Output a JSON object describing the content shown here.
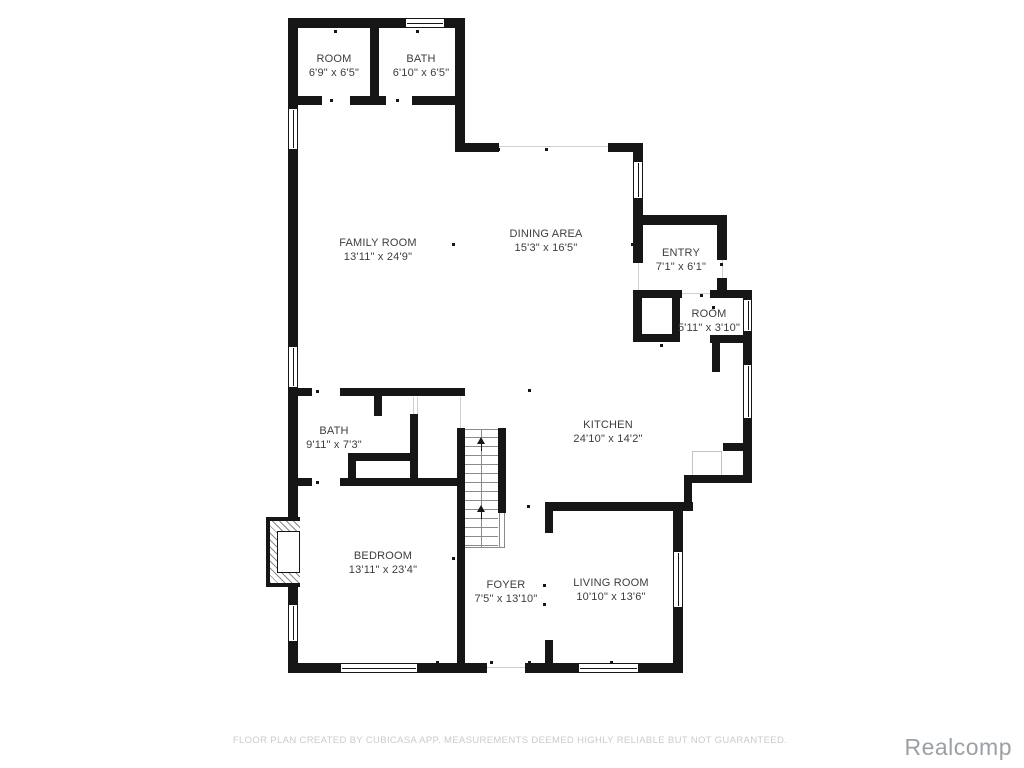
{
  "footer": {
    "disclaimer": "FLOOR PLAN CREATED BY CUBICASA APP. MEASUREMENTS DEEMED HIGHLY RELIABLE BUT NOT GUARANTEED.",
    "watermark": "Realcomp"
  },
  "colors": {
    "wall": "#161616",
    "label": "#3d3d3d",
    "opening_line": "#cfcfcf",
    "stair_line": "#8a8a8a",
    "disclaimer": "#cbcbcb",
    "watermark": "#9aa0a5"
  },
  "rooms": [
    {
      "id": "room-top",
      "name": "ROOM",
      "dims": "6'9\" x 6'5\"",
      "cx": 334,
      "cy": 66
    },
    {
      "id": "bath-top",
      "name": "BATH",
      "dims": "6'10\" x 6'5\"",
      "cx": 421,
      "cy": 66
    },
    {
      "id": "family-room",
      "name": "FAMILY ROOM",
      "dims": "13'11\" x 24'9\"",
      "cx": 378,
      "cy": 250
    },
    {
      "id": "dining-area",
      "name": "DINING AREA",
      "dims": "15'3\" x 16'5\"",
      "cx": 546,
      "cy": 241
    },
    {
      "id": "entry",
      "name": "ENTRY",
      "dims": "7'1\" x 6'1\"",
      "cx": 681,
      "cy": 260
    },
    {
      "id": "room-side",
      "name": "ROOM",
      "dims": "5'11\" x 3'10\"",
      "cx": 709,
      "cy": 321
    },
    {
      "id": "bath-main",
      "name": "BATH",
      "dims": "9'11\" x 7'3\"",
      "cx": 334,
      "cy": 438
    },
    {
      "id": "kitchen",
      "name": "KITCHEN",
      "dims": "24'10\" x 14'2\"",
      "cx": 608,
      "cy": 432
    },
    {
      "id": "bedroom",
      "name": "BEDROOM",
      "dims": "13'11\" x 23'4\"",
      "cx": 383,
      "cy": 563
    },
    {
      "id": "foyer",
      "name": "FOYER",
      "dims": "7'5\" x 13'10\"",
      "cx": 506,
      "cy": 592
    },
    {
      "id": "living-room",
      "name": "LIVING ROOM",
      "dims": "10'10\" x 13'6\"",
      "cx": 611,
      "cy": 590
    }
  ],
  "plan": {
    "walls": [
      [
        288,
        18,
        177,
        10
      ],
      [
        288,
        18,
        10,
        378
      ],
      [
        288,
        396,
        10,
        126
      ],
      [
        288,
        582,
        10,
        90
      ],
      [
        370,
        24,
        9,
        76
      ],
      [
        288,
        96,
        34,
        9
      ],
      [
        350,
        96,
        36,
        9
      ],
      [
        412,
        96,
        53,
        9
      ],
      [
        455,
        18,
        10,
        134
      ],
      [
        455,
        143,
        44,
        9
      ],
      [
        608,
        143,
        35,
        9
      ],
      [
        633,
        143,
        10,
        82
      ],
      [
        633,
        225,
        10,
        38
      ],
      [
        633,
        215,
        94,
        10
      ],
      [
        717,
        215,
        10,
        45
      ],
      [
        717,
        278,
        10,
        20
      ],
      [
        633,
        290,
        49,
        8
      ],
      [
        710,
        290,
        42,
        8
      ],
      [
        633,
        290,
        9,
        52
      ],
      [
        672,
        290,
        8,
        52
      ],
      [
        633,
        334,
        47,
        8
      ],
      [
        743,
        290,
        9,
        53
      ],
      [
        710,
        335,
        42,
        8
      ],
      [
        712,
        343,
        8,
        29
      ],
      [
        743,
        335,
        9,
        148
      ],
      [
        723,
        443,
        20,
        8
      ],
      [
        684,
        475,
        68,
        8
      ],
      [
        684,
        475,
        8,
        35
      ],
      [
        545,
        502,
        148,
        9
      ],
      [
        545,
        502,
        8,
        31
      ],
      [
        673,
        502,
        10,
        170
      ],
      [
        545,
        640,
        8,
        27
      ],
      [
        288,
        663,
        199,
        10
      ],
      [
        525,
        663,
        158,
        10
      ],
      [
        288,
        388,
        24,
        8
      ],
      [
        340,
        388,
        125,
        8
      ],
      [
        374,
        396,
        8,
        20
      ],
      [
        410,
        414,
        8,
        70
      ],
      [
        348,
        453,
        69,
        8
      ],
      [
        348,
        461,
        8,
        25
      ],
      [
        288,
        478,
        24,
        8
      ],
      [
        340,
        478,
        117,
        8
      ],
      [
        457,
        428,
        8,
        244
      ],
      [
        498,
        428,
        8,
        85
      ]
    ],
    "windows": [
      [
        405,
        18,
        40,
        10
      ],
      [
        288,
        108,
        10,
        42
      ],
      [
        288,
        346,
        10,
        42
      ],
      [
        288,
        604,
        10,
        38
      ],
      [
        633,
        161,
        10,
        38
      ],
      [
        743,
        299,
        9,
        33
      ],
      [
        743,
        364,
        9,
        55
      ],
      [
        673,
        551,
        10,
        57
      ],
      [
        340,
        663,
        78,
        10
      ],
      [
        578,
        663,
        61,
        10
      ]
    ],
    "openings": [
      [
        499,
        146,
        109,
        1
      ],
      [
        682,
        293,
        28,
        1
      ],
      [
        487,
        667,
        38,
        1
      ],
      [
        722,
        260,
        1,
        18
      ],
      [
        638,
        263,
        1,
        27
      ],
      [
        413,
        397,
        1,
        17
      ],
      [
        417,
        397,
        1,
        17
      ],
      [
        460,
        397,
        1,
        31
      ]
    ],
    "stair_lines": [
      [
        465,
        429,
        33,
        1
      ],
      [
        481,
        430,
        1,
        117
      ],
      [
        465,
        437,
        33,
        1
      ],
      [
        465,
        446,
        33,
        1
      ],
      [
        465,
        455,
        33,
        1
      ],
      [
        465,
        464,
        33,
        1
      ],
      [
        465,
        473,
        33,
        1
      ],
      [
        465,
        482,
        33,
        1
      ],
      [
        465,
        491,
        33,
        1
      ],
      [
        465,
        500,
        33,
        1
      ],
      [
        465,
        509,
        33,
        1
      ],
      [
        465,
        518,
        33,
        1
      ],
      [
        465,
        527,
        33,
        1
      ],
      [
        465,
        536,
        33,
        1
      ],
      [
        465,
        545,
        33,
        1
      ],
      [
        499,
        513,
        1,
        35
      ],
      [
        504,
        513,
        1,
        35
      ],
      [
        465,
        547,
        40,
        1
      ]
    ],
    "ticks": [
      [
        334,
        30
      ],
      [
        416,
        30
      ],
      [
        330,
        99
      ],
      [
        396,
        99
      ],
      [
        294,
        243
      ],
      [
        452,
        243
      ],
      [
        497,
        148
      ],
      [
        545,
        148
      ],
      [
        631,
        243
      ],
      [
        678,
        217
      ],
      [
        720,
        263
      ],
      [
        712,
        306
      ],
      [
        700,
        294
      ],
      [
        660,
        344
      ],
      [
        528,
        389
      ],
      [
        316,
        390
      ],
      [
        316,
        481
      ],
      [
        543,
        584
      ],
      [
        543,
        603
      ],
      [
        527,
        505
      ],
      [
        490,
        661
      ],
      [
        528,
        661
      ],
      [
        436,
        661
      ],
      [
        610,
        661
      ],
      [
        748,
        338
      ],
      [
        452,
        557
      ]
    ],
    "arrows": [
      [
        481,
        437
      ],
      [
        481,
        505
      ]
    ],
    "fireplace": {
      "frame": [
        266,
        517,
        34,
        70
      ],
      "hatch": [
        270,
        521,
        30,
        62
      ],
      "firebox": [
        277,
        531,
        23,
        42
      ]
    },
    "ghosts": [
      [
        692,
        451,
        30,
        30
      ]
    ]
  }
}
